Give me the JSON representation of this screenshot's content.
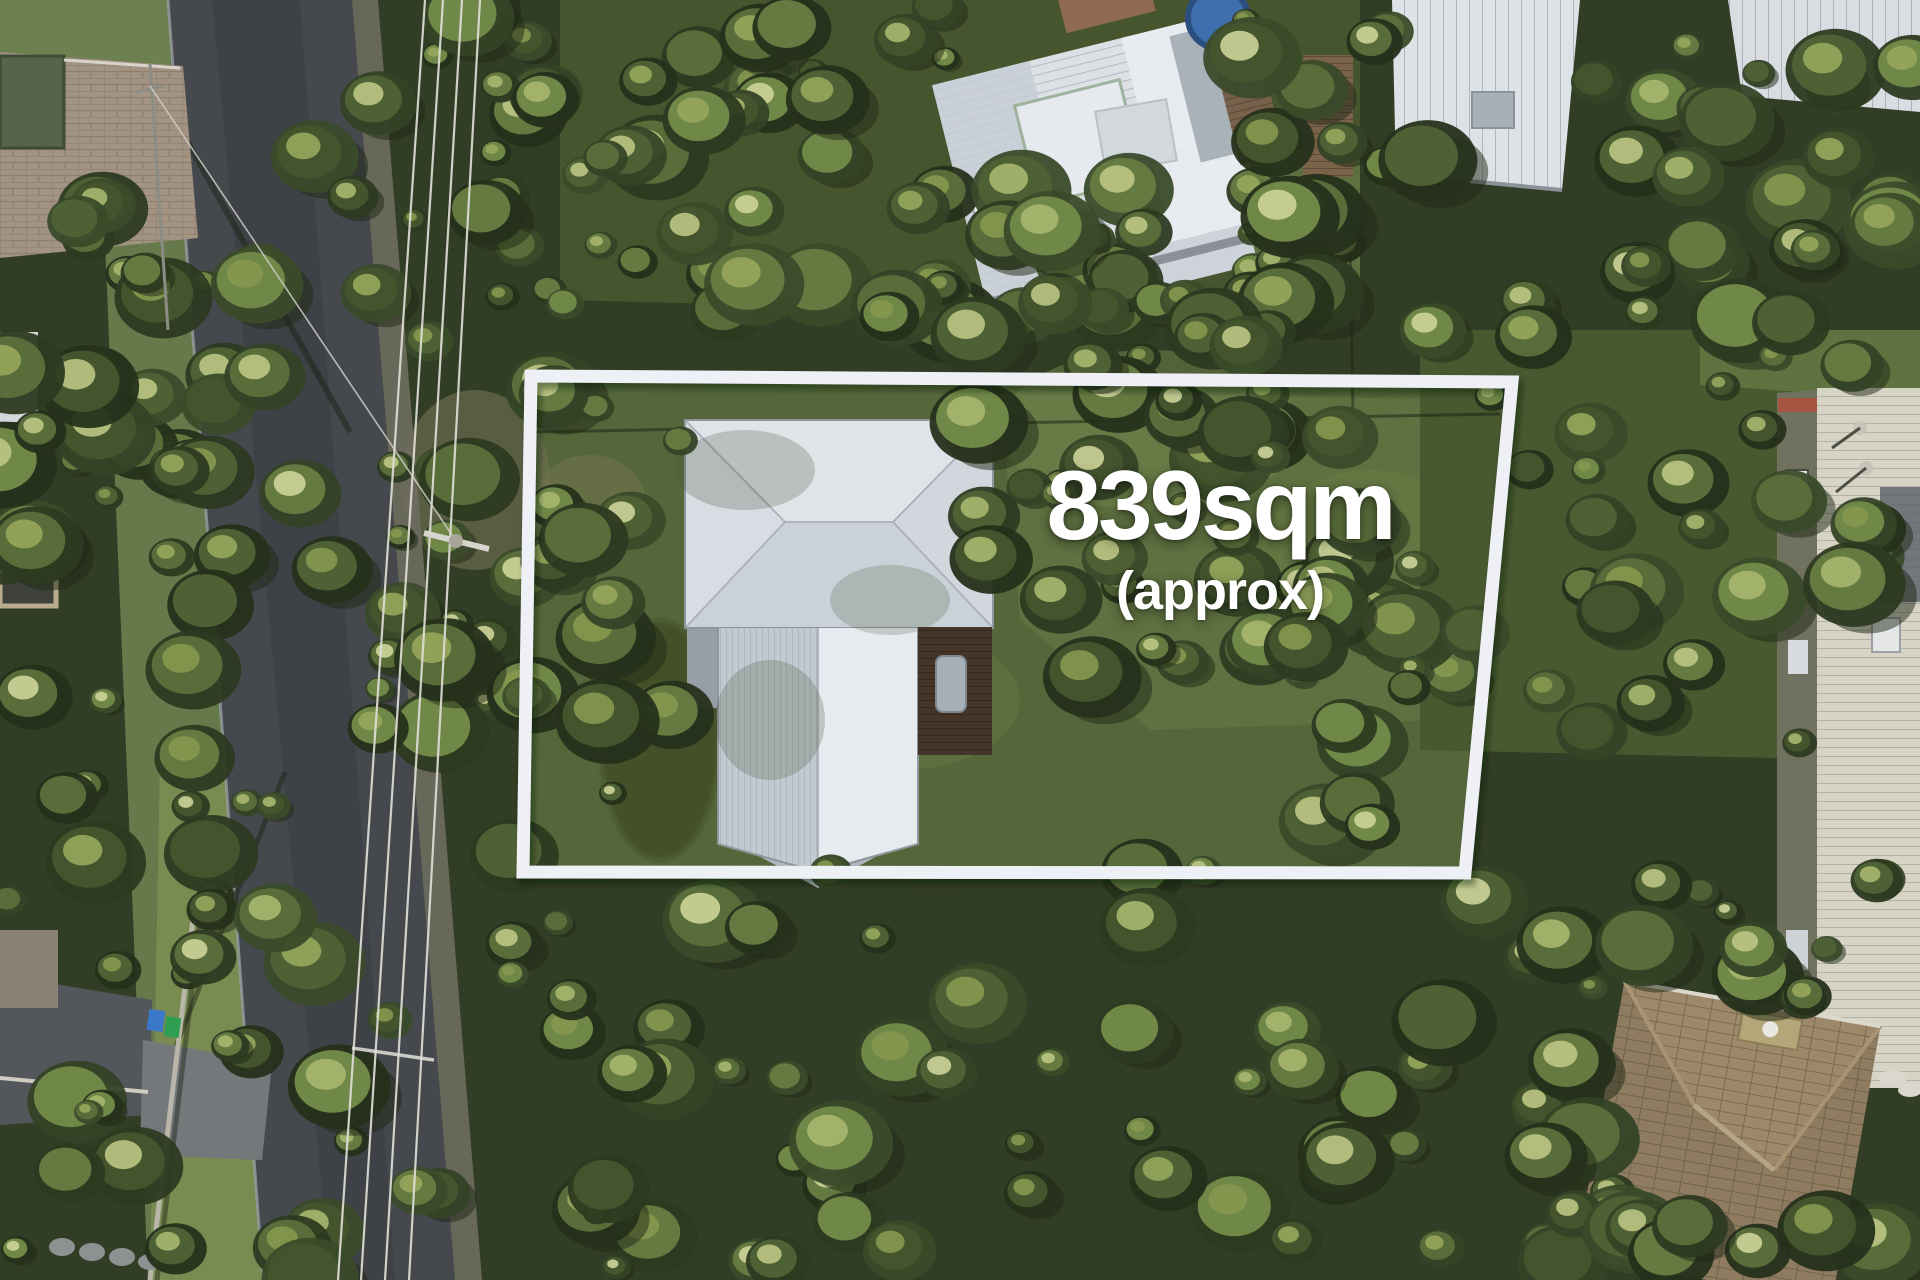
{
  "overlay": {
    "area_label": "839sqm",
    "area_qualifier": "(approx)"
  },
  "palette": {
    "boundary_white": "#eef0f6",
    "label_text": "#ffffff",
    "canopy_green": "#313d24",
    "lawn_green": "#55673a",
    "road_asphalt": "#45494d",
    "subject_roof_gray": "#d5dae0",
    "deck_brown": "#453528",
    "tile_roof_tan": "#8f7c60"
  }
}
